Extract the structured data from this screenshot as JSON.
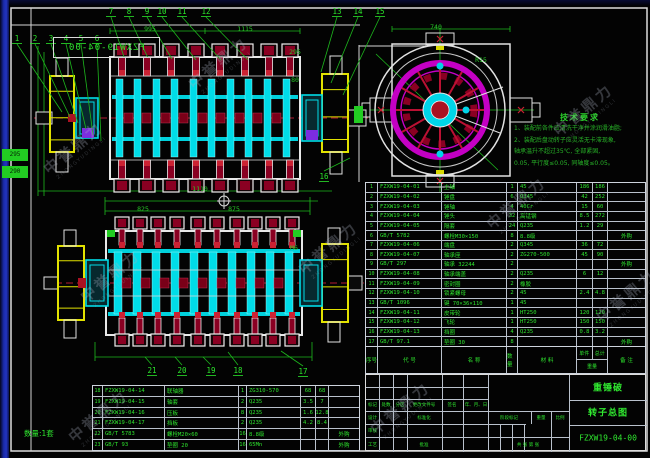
{
  "drawing": {
    "number": "FZXW19-04-00",
    "mirrored_number": "FZXW19-04-00",
    "quantity_note": "数量:1套",
    "watermark_cn": "中誉鼎力",
    "watermark_en": "ZHONGYUDINGLI"
  },
  "balloons": {
    "group_left": [
      "1",
      "2",
      "3",
      "4",
      "5",
      "6"
    ],
    "group_top": [
      "7",
      "8",
      "9",
      "10",
      "11",
      "12"
    ],
    "group_topright": [
      "13",
      "14",
      "15"
    ],
    "group_side": [
      "16"
    ],
    "group_bottom": [
      "21",
      "20",
      "19",
      "18",
      "17"
    ]
  },
  "dim_labels": [
    {
      "key": "v1a",
      "text": "995"
    },
    {
      "key": "v1b",
      "text": "1115"
    },
    {
      "key": "v1c",
      "text": "1110"
    },
    {
      "key": "v2a",
      "text": "825"
    },
    {
      "key": "v2b",
      "text": "875"
    },
    {
      "key": "ev",
      "text": "740"
    },
    {
      "key": "m6",
      "text": "M6"
    },
    {
      "key": "r15",
      "text": "R15"
    },
    {
      "key": "s295",
      "text": "295"
    },
    {
      "key": "s80",
      "text": "80"
    }
  ],
  "green_tags": [
    {
      "text": "295"
    },
    {
      "text": "290"
    },
    {
      "text": ""
    }
  ],
  "notes": {
    "title": "技术要求",
    "lines": [
      "1、装配前各件应清洗干净并涂润滑油脂;",
      "2、装配后盘动转子应灵活无卡滞现象,",
      "轴承温升不超过35℃, 全部紧固,",
      "0.05, 平行度≤0.05, 同轴度≤0.05。"
    ]
  },
  "bom_upper": {
    "headers": {
      "no": "序号",
      "code": "代 号",
      "name": "名 称",
      "qty": "数量",
      "mat": "材 料",
      "unit": "单件",
      "total": "总计",
      "weight": "重量",
      "remark": "备 注"
    },
    "rows": [
      [
        "1",
        "FZXW19-04-01",
        "主轴",
        "1",
        "45",
        "186",
        "186",
        ""
      ],
      [
        "2",
        "FZXW19-04-02",
        "锤盘",
        "6",
        "Q345",
        "42",
        "252",
        ""
      ],
      [
        "3",
        "FZXW19-04-03",
        "锤轴",
        "4",
        "40Cr",
        "15",
        "60",
        ""
      ],
      [
        "4",
        "FZXW19-04-04",
        "锤头",
        "32",
        "高锰钢",
        "8.5",
        "272",
        ""
      ],
      [
        "5",
        "FZXW19-04-05",
        "隔套",
        "24",
        "Q235",
        "1.2",
        "29",
        ""
      ],
      [
        "6",
        "GB/T 5782",
        "螺栓M30×150",
        "8",
        "8.8级",
        "",
        "",
        "外购"
      ],
      [
        "7",
        "FZXW19-04-06",
        "端盘",
        "2",
        "Q345",
        "36",
        "72",
        ""
      ],
      [
        "8",
        "FZXW19-04-07",
        "轴承座",
        "2",
        "ZG270-500",
        "45",
        "90",
        ""
      ],
      [
        "9",
        "GB/T 297",
        "轴承 32244",
        "2",
        "",
        "",
        "",
        "外购"
      ],
      [
        "10",
        "FZXW19-04-08",
        "轴承端盖",
        "2",
        "Q235",
        "6",
        "12",
        ""
      ],
      [
        "11",
        "FZXW19-04-09",
        "密封圈",
        "2",
        "橡胶",
        "",
        "",
        ""
      ],
      [
        "12",
        "FZXW19-04-10",
        "锁紧螺母",
        "2",
        "45",
        "2.4",
        "4.8",
        ""
      ],
      [
        "13",
        "GB/T 1096",
        "键 70×36×110",
        "1",
        "45",
        "",
        "",
        ""
      ],
      [
        "14",
        "FZXW19-04-11",
        "皮带轮",
        "1",
        "HT250",
        "120",
        "120",
        ""
      ],
      [
        "15",
        "FZXW19-04-12",
        "飞轮",
        "1",
        "HT250",
        "150",
        "150",
        ""
      ],
      [
        "16",
        "FZXW19-04-13",
        "挡圈",
        "4",
        "Q235",
        "0.8",
        "3.2",
        ""
      ],
      [
        "17",
        "GB/T 97.1",
        "垫圈 30",
        "8",
        "",
        "",
        "",
        "外购"
      ]
    ]
  },
  "bom_lower": {
    "rows": [
      [
        "18",
        "FZXW19-04-14",
        "联轴器",
        "1",
        "ZG310-570",
        "68",
        "68",
        ""
      ],
      [
        "19",
        "FZXW19-04-15",
        "轴套",
        "2",
        "Q235",
        "3.5",
        "7",
        ""
      ],
      [
        "20",
        "FZXW19-04-16",
        "压板",
        "8",
        "Q235",
        "1.6",
        "12.8",
        ""
      ],
      [
        "21",
        "FZXW19-04-17",
        "挡板",
        "2",
        "Q235",
        "4.2",
        "8.4",
        ""
      ],
      [
        "22",
        "GB/T 5783",
        "螺栓M20×60",
        "16",
        "8.8级",
        "",
        "",
        "外购"
      ],
      [
        "23",
        "GB/T 93",
        "垫圈 20",
        "16",
        "65Mn",
        "",
        "",
        "外购"
      ]
    ]
  },
  "title_block": {
    "product": "重锤破",
    "sheet_title": "转子总图",
    "number": "FZXW19-04-00",
    "labels": {
      "mark": "标记",
      "count": "处数",
      "zone": "分区",
      "change_doc": "更改文件号",
      "sign": "签名",
      "date": "年、月、日",
      "design": "设计",
      "standard": "标准化",
      "check": "审核",
      "process": "工艺",
      "approve": "批准",
      "stage": "阶段标记",
      "weight": "重量",
      "scale": "比例",
      "sheets": "共  张  第  张"
    }
  },
  "colors": {
    "line_green": "#1db81d",
    "text_green": "#2ee32e",
    "cyan": "#00dce8",
    "yellow": "#e2e200",
    "dark_red": "#8a0022",
    "magenta": "#c400c4",
    "white": "#e2e2e2",
    "blue_edge": "#1a2aa8"
  }
}
